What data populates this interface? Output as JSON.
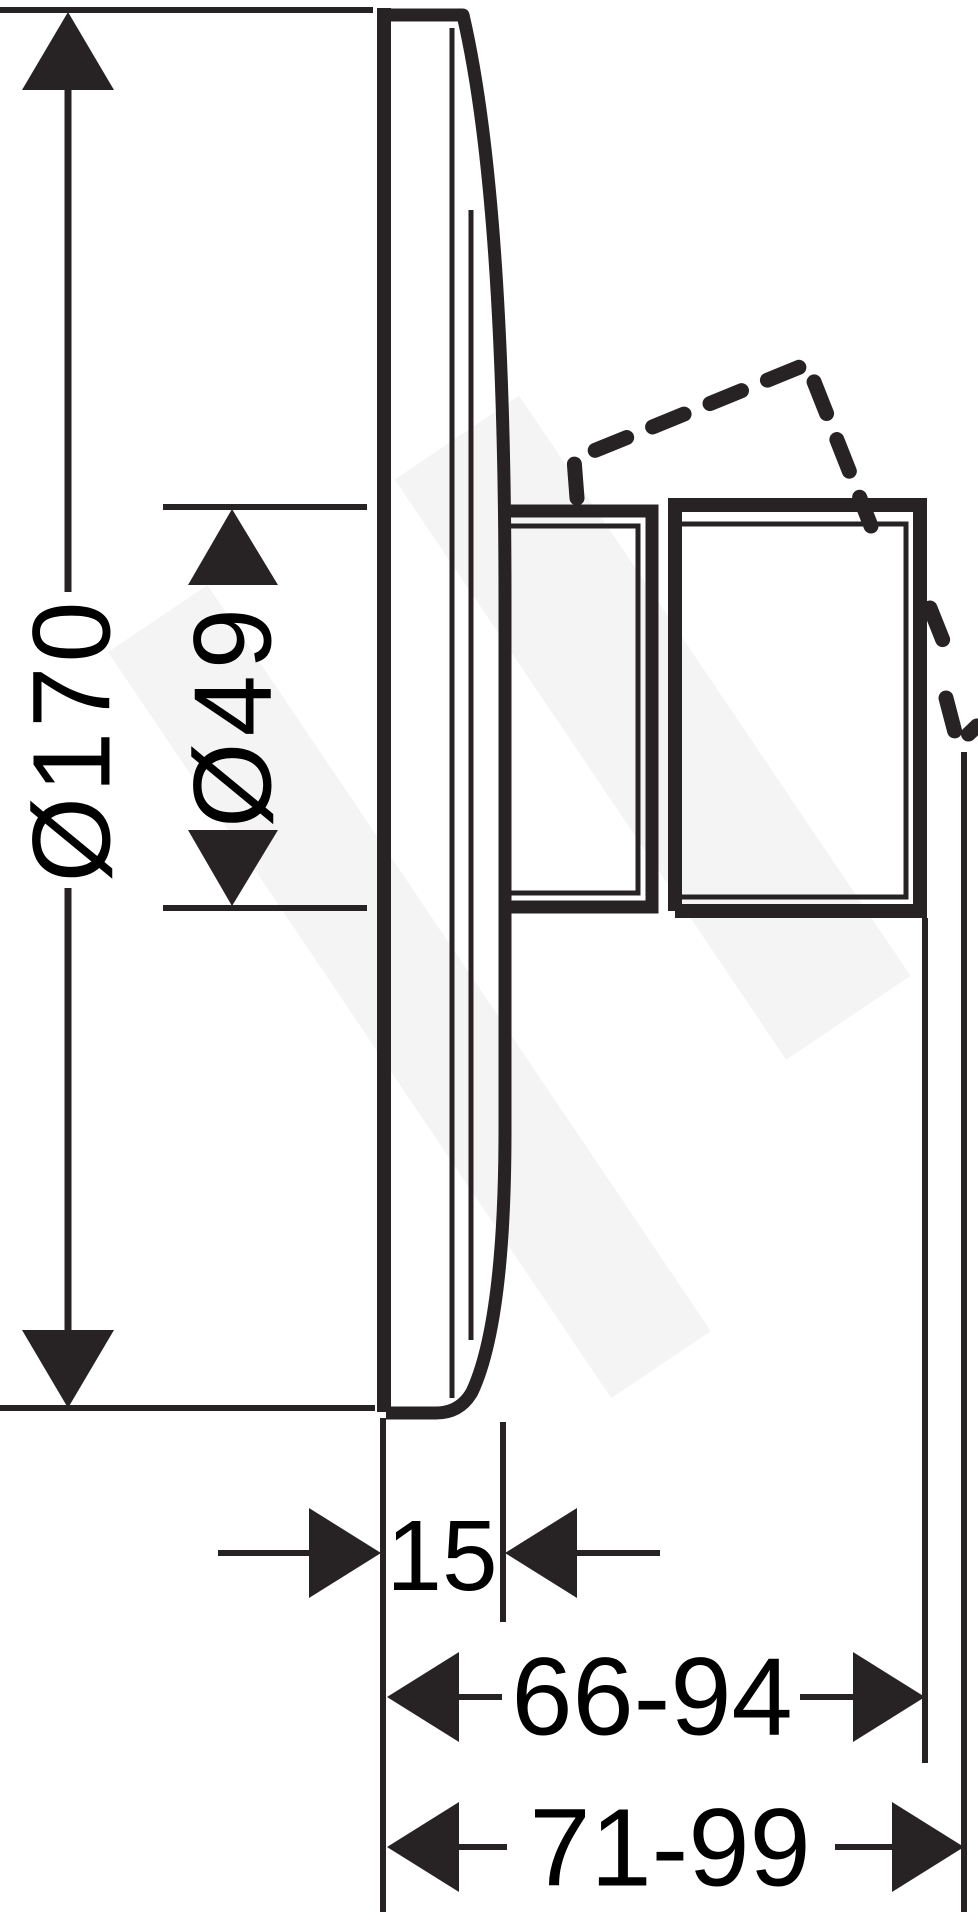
{
  "drawing": {
    "type": "technical-dimension-drawing",
    "subject": "concealed-shower-mixer-side-view",
    "ink_color": "#272325",
    "background_color": "#ffffff",
    "dimensions": [
      {
        "id": "plate-diameter",
        "label": "Ø170",
        "orientation": "vertical",
        "unit": "mm"
      },
      {
        "id": "hub-diameter",
        "label": "Ø49",
        "orientation": "vertical",
        "unit": "mm"
      },
      {
        "id": "plate-depth",
        "label": "15",
        "orientation": "horizontal",
        "unit": "mm"
      },
      {
        "id": "body-projection",
        "label": "66-94",
        "orientation": "horizontal",
        "unit": "mm"
      },
      {
        "id": "total-projection",
        "label": "71-99",
        "orientation": "horizontal",
        "unit": "mm"
      }
    ]
  }
}
